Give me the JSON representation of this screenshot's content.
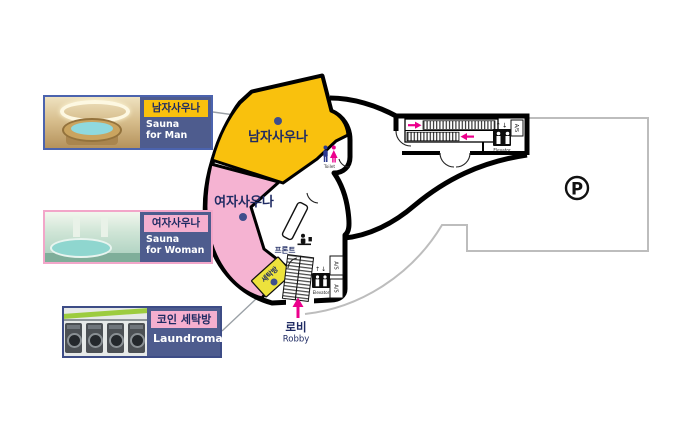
{
  "cards": [
    {
      "tag": "남자사우나",
      "line1": "Sauna",
      "line2": "for Man"
    },
    {
      "tag": "여자사우나",
      "line1": "Sauna",
      "line2": "for Woman"
    },
    {
      "tag": "코인 세탁방",
      "line1": "Laundromat",
      "line2": ""
    }
  ],
  "plan": {
    "men_area_label": "남자사우나",
    "women_area_label": "여자사우나",
    "laundry_room_label": "세탁방",
    "front_desk_label": "프론트",
    "lobby_label_kr": "로비",
    "lobby_label_en": "Robby",
    "toilet_label": "Toilet",
    "elevator_label": "Elevator",
    "service_box_label": "A/S",
    "parking_symbol": "P",
    "arrows": {
      "elevator_updown": "↑↓"
    }
  },
  "colors": {
    "men_area": "#F9C10D",
    "women_area": "#F5B3D2",
    "laundry_box": "#EDE23C",
    "card_panel_blue": "#4E5C8E",
    "tag_yellow": "#F9C10D",
    "tag_pink": "#F5AFCF",
    "navy_text": "#1F2B63",
    "magenta": "#EC008C",
    "toilet_man_blue": "#2B3990",
    "leader_dot": "#3E4E8C",
    "parking_outline": "#BDBDBD"
  }
}
